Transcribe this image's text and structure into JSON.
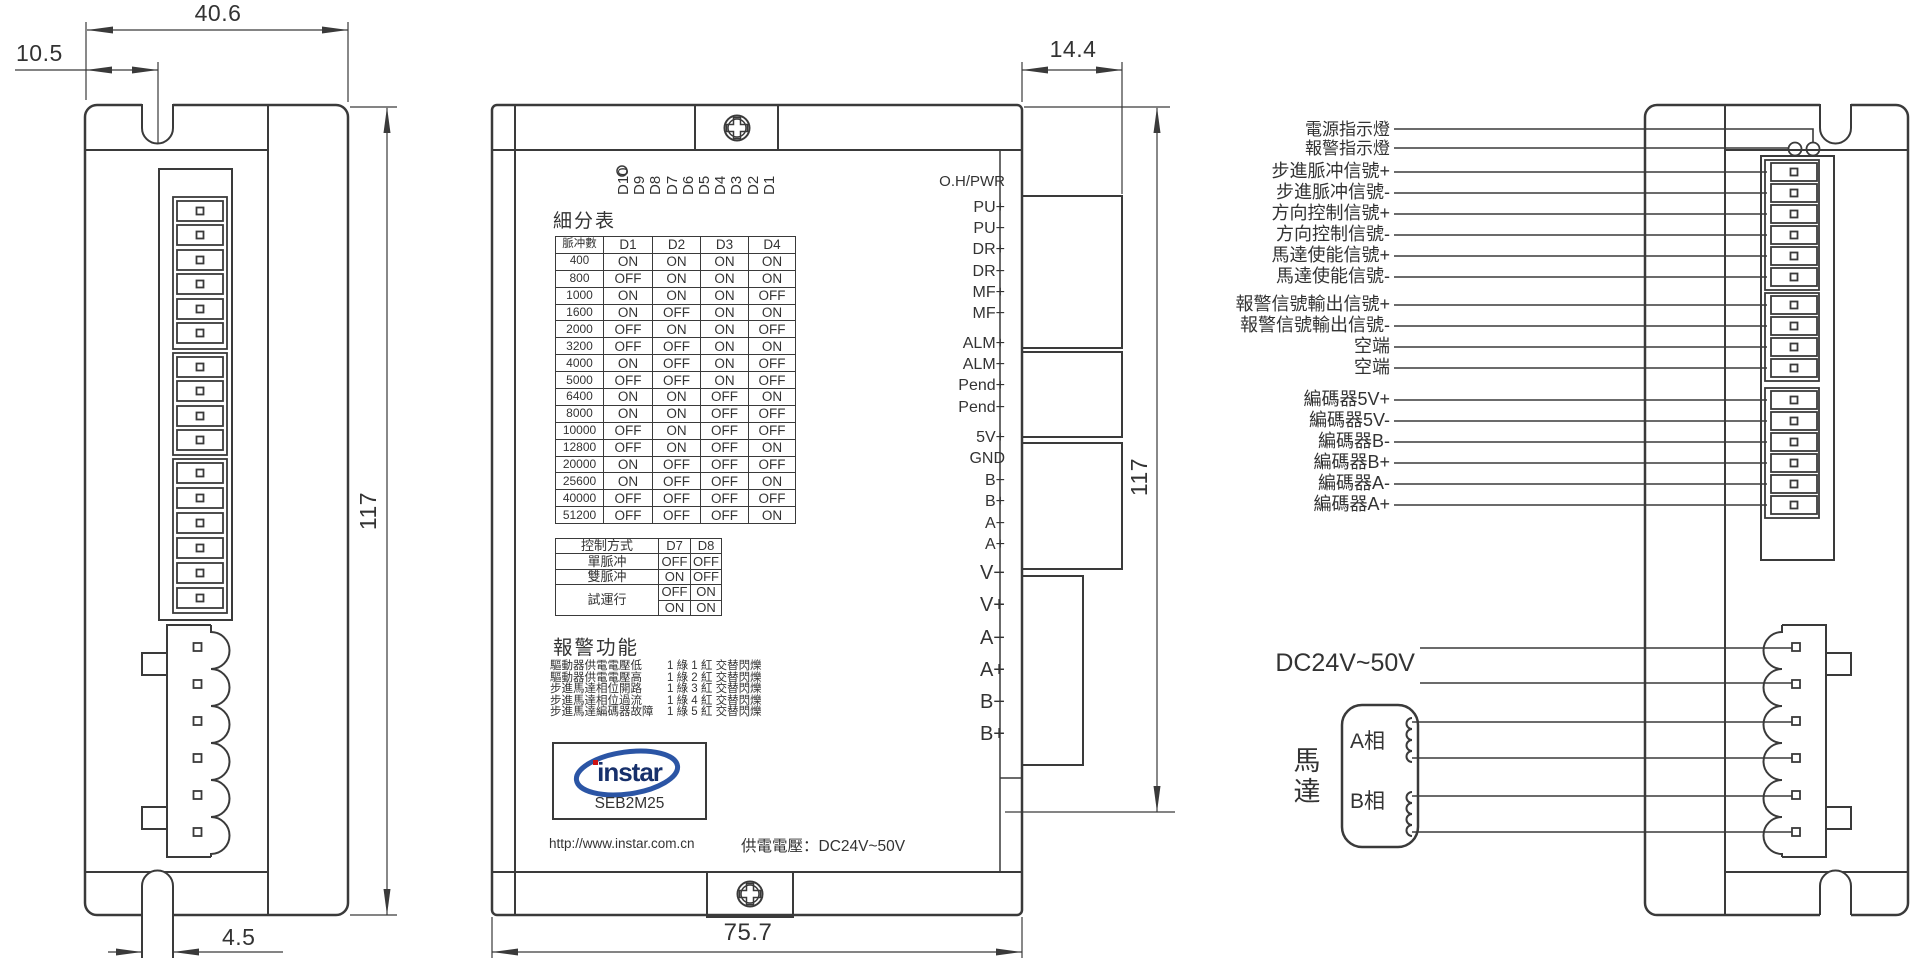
{
  "dims": {
    "width_top": "40.6",
    "notch_offset": "10.5",
    "terminal_depth": "14.4",
    "height_left": "117",
    "height_front": "117",
    "width_bottom": "75.7",
    "slot_width": "4.5"
  },
  "front": {
    "dip_labels": [
      "D10",
      "D9",
      "D8",
      "D7",
      "D6",
      "D5",
      "D4",
      "D3",
      "D2",
      "D1"
    ],
    "microstep_title": "細分表",
    "microstep_table": {
      "headers": [
        "脈冲數",
        "D1",
        "D2",
        "D3",
        "D4"
      ],
      "rows": [
        [
          "400",
          "ON",
          "ON",
          "ON",
          "ON"
        ],
        [
          "800",
          "OFF",
          "ON",
          "ON",
          "ON"
        ],
        [
          "1000",
          "ON",
          "ON",
          "ON",
          "OFF"
        ],
        [
          "1600",
          "ON",
          "OFF",
          "ON",
          "ON"
        ],
        [
          "2000",
          "OFF",
          "ON",
          "ON",
          "OFF"
        ],
        [
          "3200",
          "OFF",
          "OFF",
          "ON",
          "ON"
        ],
        [
          "4000",
          "ON",
          "OFF",
          "ON",
          "OFF"
        ],
        [
          "5000",
          "OFF",
          "OFF",
          "ON",
          "OFF"
        ],
        [
          "6400",
          "ON",
          "ON",
          "OFF",
          "ON"
        ],
        [
          "8000",
          "ON",
          "ON",
          "OFF",
          "OFF"
        ],
        [
          "10000",
          "OFF",
          "ON",
          "OFF",
          "OFF"
        ],
        [
          "12800",
          "OFF",
          "ON",
          "OFF",
          "ON"
        ],
        [
          "20000",
          "ON",
          "OFF",
          "OFF",
          "OFF"
        ],
        [
          "25600",
          "ON",
          "OFF",
          "OFF",
          "ON"
        ],
        [
          "40000",
          "OFF",
          "OFF",
          "OFF",
          "OFF"
        ],
        [
          "51200",
          "OFF",
          "OFF",
          "OFF",
          "ON"
        ]
      ]
    },
    "control_table": {
      "headers": [
        "控制方式",
        "D7",
        "D8"
      ],
      "rows": [
        {
          "label": "單脈冲",
          "d7": "OFF",
          "d8": "OFF"
        },
        {
          "label": "雙脈冲",
          "d7": "ON",
          "d8": "OFF"
        },
        {
          "label": "試運行",
          "d7": "OFF",
          "d8": "ON"
        },
        {
          "label": "",
          "d7": "ON",
          "d8": "ON"
        }
      ]
    },
    "alarm_title": "報警功能",
    "alarms": [
      {
        "name": "驅動器供電電壓低",
        "pattern": "1 綠 1 紅  交替閃爍"
      },
      {
        "name": "驅動器供電電壓高",
        "pattern": "1 綠 2 紅  交替閃爍"
      },
      {
        "name": "步進馬達相位開路",
        "pattern": "1 綠 3 紅  交替閃爍"
      },
      {
        "name": "步進馬達相位過流",
        "pattern": "1 綠 4 紅  交替閃爍"
      },
      {
        "name": "步進馬達編碼器故障",
        "pattern": "1 綠 5 紅  交替閃爍"
      }
    ],
    "logo": {
      "brand": "instar",
      "model": "SEB2M25"
    },
    "url": "http://www.instar.com.cn",
    "supply_note": "供電電壓：DC24V~50V",
    "status_led": "O.H/PWR",
    "terminals": {
      "signal": [
        "PU+",
        "PU−",
        "DR+",
        "DR−",
        "MF+",
        "MF−"
      ],
      "alarm": [
        "ALM+",
        "ALM−",
        "Pend+",
        "Pend−"
      ],
      "encoder": [
        "5V+",
        "GND",
        "B−",
        "B+",
        "A−",
        "A+"
      ],
      "power": [
        "V−",
        "V+",
        "A−",
        "A+",
        "B−",
        "B+"
      ]
    }
  },
  "wiring": {
    "indicators": [
      "電源指示燈",
      "報警指示燈"
    ],
    "signals": [
      "步進脈冲信號+",
      "步進脈冲信號-",
      "方向控制信號+",
      "方向控制信號-",
      "馬達使能信號+",
      "馬達使能信號-"
    ],
    "alarm_outputs": [
      "報警信號輸出信號+",
      "報警信號輸出信號-",
      "空端",
      "空端"
    ],
    "encoder": [
      "編碼器5V+",
      "編碼器5V-",
      "編碼器B-",
      "編碼器B+",
      "編碼器A-",
      "編碼器A+"
    ],
    "supply": "DC24V~50V",
    "motor_label": "馬達",
    "phase_a": "A相",
    "phase_b": "B相"
  },
  "colors": {
    "line": "#3a3a3a",
    "logo_blue": "#2b55a5",
    "logo_navy": "#17306b",
    "logo_red": "#cc1111"
  }
}
